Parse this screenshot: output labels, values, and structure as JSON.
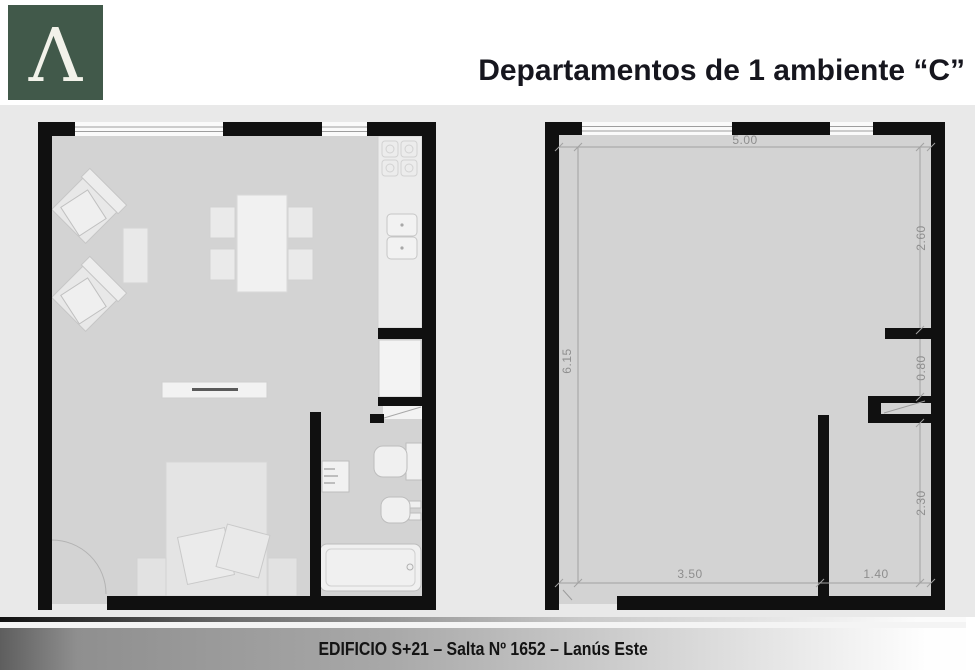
{
  "header": {
    "logo_letter": "Λ",
    "title": "Departamentos de 1 ambiente “C”"
  },
  "colors": {
    "logo_green": "#41594a",
    "wall_black": "#101010",
    "floor_gray": "#d3d3d3",
    "band_gray": "#e9e9e9",
    "dim_gray": "#8e8e8e",
    "dim_line": "#a2a2a2"
  },
  "dimensions": {
    "top_width": "5.00",
    "left_height": "6.15",
    "right_upper": "2.60",
    "right_middle": "0.80",
    "right_lower": "2.30",
    "bottom_left": "3.50",
    "bottom_right": "1.40"
  },
  "footer": {
    "text": "EDIFICIO S+21 – Salta Nº 1652 – Lanús Este"
  }
}
